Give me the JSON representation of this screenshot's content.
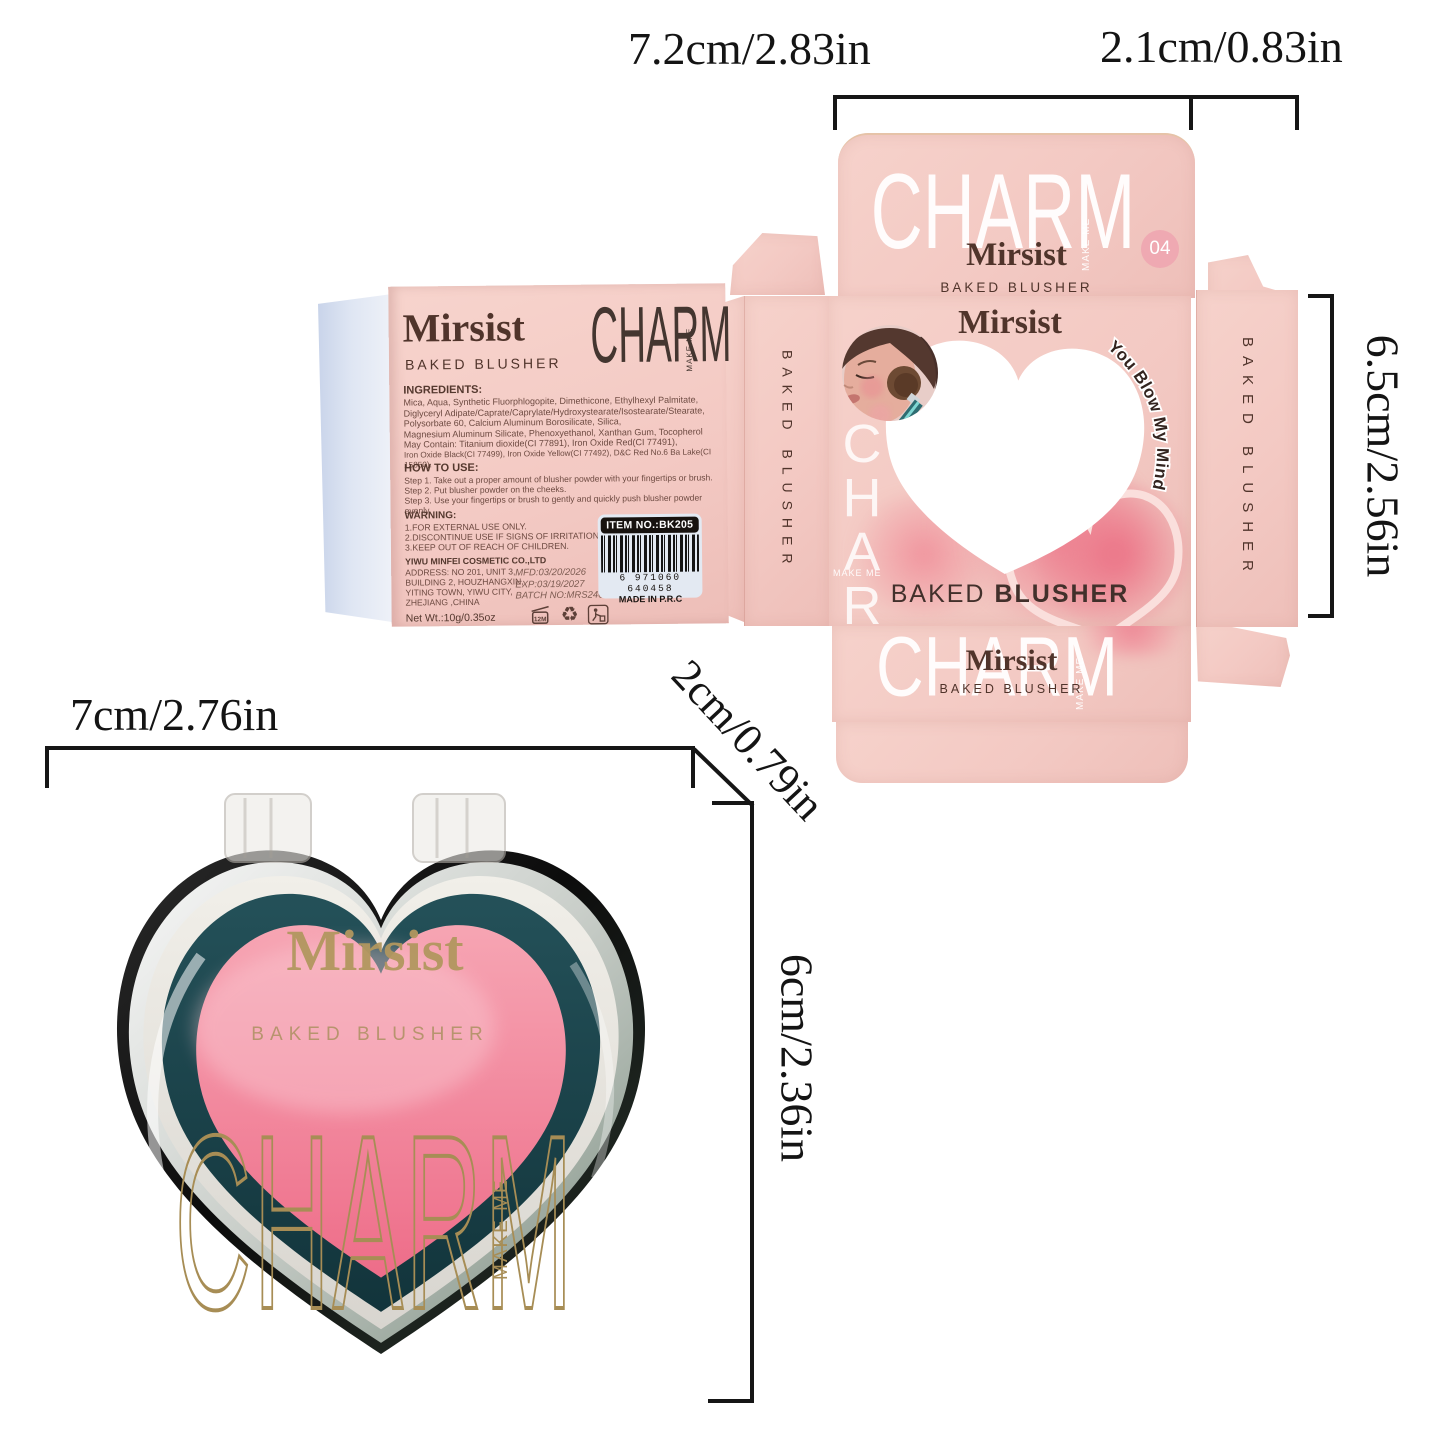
{
  "dimensions": {
    "box_width": "7.2cm/2.83in",
    "box_depth": "2.1cm/0.83in",
    "box_height": "6.5cm/2.56in",
    "compact_width": "7cm/2.76in",
    "compact_depth": "2cm/0.79in",
    "compact_height": "6cm/2.36in"
  },
  "brand": {
    "name": "Mirsist",
    "product": "BAKED BLUSHER",
    "product_words": [
      "BAKED",
      "BLUSHER"
    ],
    "logo": "CHARM",
    "logo_sub": "MAKE ME",
    "shade_number": "04",
    "tagline": "You Blow My Mind."
  },
  "side_panel": {
    "ingredients_title": "INGREDIENTS:",
    "ingredients_lines": [
      "Mica, Aqua, Synthetic Fluorphlogopite, Dimethicone, Ethylhexyl Palmitate,",
      "Diglyceryl Adipate/Caprate/Caprylate/Hydroxystearate/Isostearate/Stearate,",
      "Polysorbate 60, Calcium Aluminum Borosilicate, Silica,",
      "Magnesium Aluminum Silicate, Phenoxyethanol, Xanthan Gum, Tocopherol",
      "May Contain: Titanium dioxide(CI 77891), Iron Oxide Red(CI 77491),",
      "Iron Oxide Black(CI 77499), Iron Oxide Yellow(CI 77492), D&C Red No.6 Ba Lake(CI 15850)."
    ],
    "how_to_use_title": "HOW TO USE:",
    "how_to_use_steps": [
      "Step 1. Take out a proper amount of blusher powder with your fingertips or brush.",
      "Step 2. Put blusher powder on the cheeks.",
      "Step 3. Use your fingertips or brush to gently and quickly push blusher powder evenly."
    ],
    "warning_title": "WARNING:",
    "warning_lines": [
      "1.FOR EXTERNAL USE ONLY.",
      "2.DISCONTINUE USE IF SIGNS OF IRRITATION APPEAR.",
      "3.KEEP OUT OF REACH OF CHILDREN."
    ],
    "manufacturer": "YIWU MINFEI COSMETIC CO.,LTD",
    "address_lines": [
      "ADDRESS: NO 201, UNIT 3,",
      "BUILDING 2, HOUZHANGXIN,",
      "YITING TOWN, YIWU CITY,",
      "ZHEJIANG ,CHINA"
    ],
    "net_weight": "Net Wt.:10g/0.35oz",
    "mfd": "MFD:03/20/2026",
    "exp": "EXP:03/19/2027",
    "batch": "BATCH NO:MRS240320",
    "item_no": "ITEM NO.:BK205",
    "barcode_digits": "6 971060 640458",
    "made_in": "MADE IN P.R.C",
    "period_after_opening": "12M"
  },
  "colors": {
    "box_pink": "#f3c9c3",
    "badge_pink": "#efa9b2",
    "text_brown": "#50342b",
    "compact_teal": "#1c4a52",
    "powder_pink": "#ee7d90",
    "gold": "#a78d55",
    "dimension_black": "#161616"
  }
}
